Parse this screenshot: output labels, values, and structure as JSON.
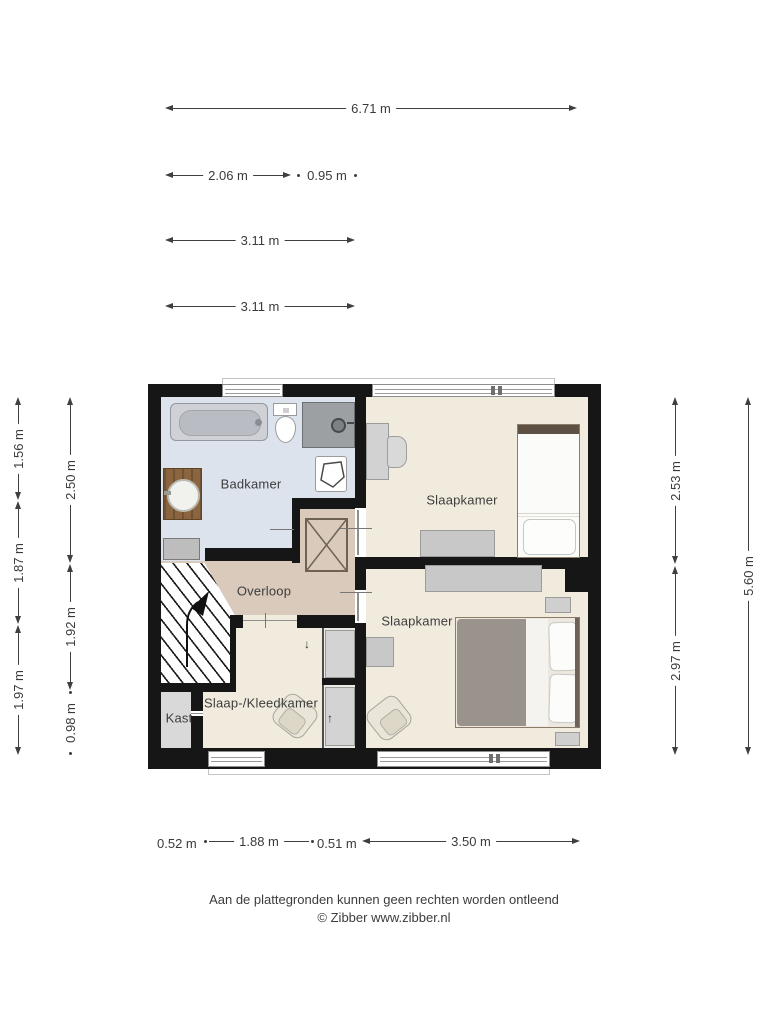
{
  "plan": {
    "rooms": {
      "badkamer": "Badkamer",
      "slaapkamer_top": "Slaapkamer",
      "slaapkamer_bottom": "Slaapkamer",
      "overloop": "Overloop",
      "slaap_kleedkamer": "Slaap-/Kleedkamer",
      "kast": "Kast"
    }
  },
  "dimensions": {
    "top_total": "6.71 m",
    "top_seg1": "2.06 m",
    "top_seg2": "0.95 m",
    "top_seg3": "3.11 m",
    "top_seg4": "3.11 m",
    "left_outer_1": "1.56 m",
    "left_outer_2": "1.87 m",
    "left_outer_3": "1.97 m",
    "left_inner_1": "2.50 m",
    "left_inner_2": "1.92 m",
    "left_inner_3": "0.98 m",
    "right_inner_1": "2.53 m",
    "right_inner_2": "2.97 m",
    "right_outer": "5.60 m",
    "bottom_seg1": "0.52 m",
    "bottom_seg2": "1.88 m",
    "bottom_seg3": "0.51 m",
    "bottom_seg4": "3.50 m"
  },
  "icons": {
    "sliding_door_down": "↓",
    "sliding_door_up": "↑"
  },
  "footer": {
    "disclaimer": "Aan de plattegronden kunnen geen rechten worden ontleend",
    "copyright": "© Zibber www.zibber.nl"
  },
  "colors": {
    "wall": "#161616",
    "bathroom_floor": "#dce3ed",
    "bedroom_floor": "#f0ebdd",
    "landing_floor": "#d9cabb",
    "closet_floor": "#d9d9d9",
    "furniture_gray": "#c8c8c8",
    "duvet_gray": "#99938b",
    "vanity_wood": "#8a6540"
  }
}
